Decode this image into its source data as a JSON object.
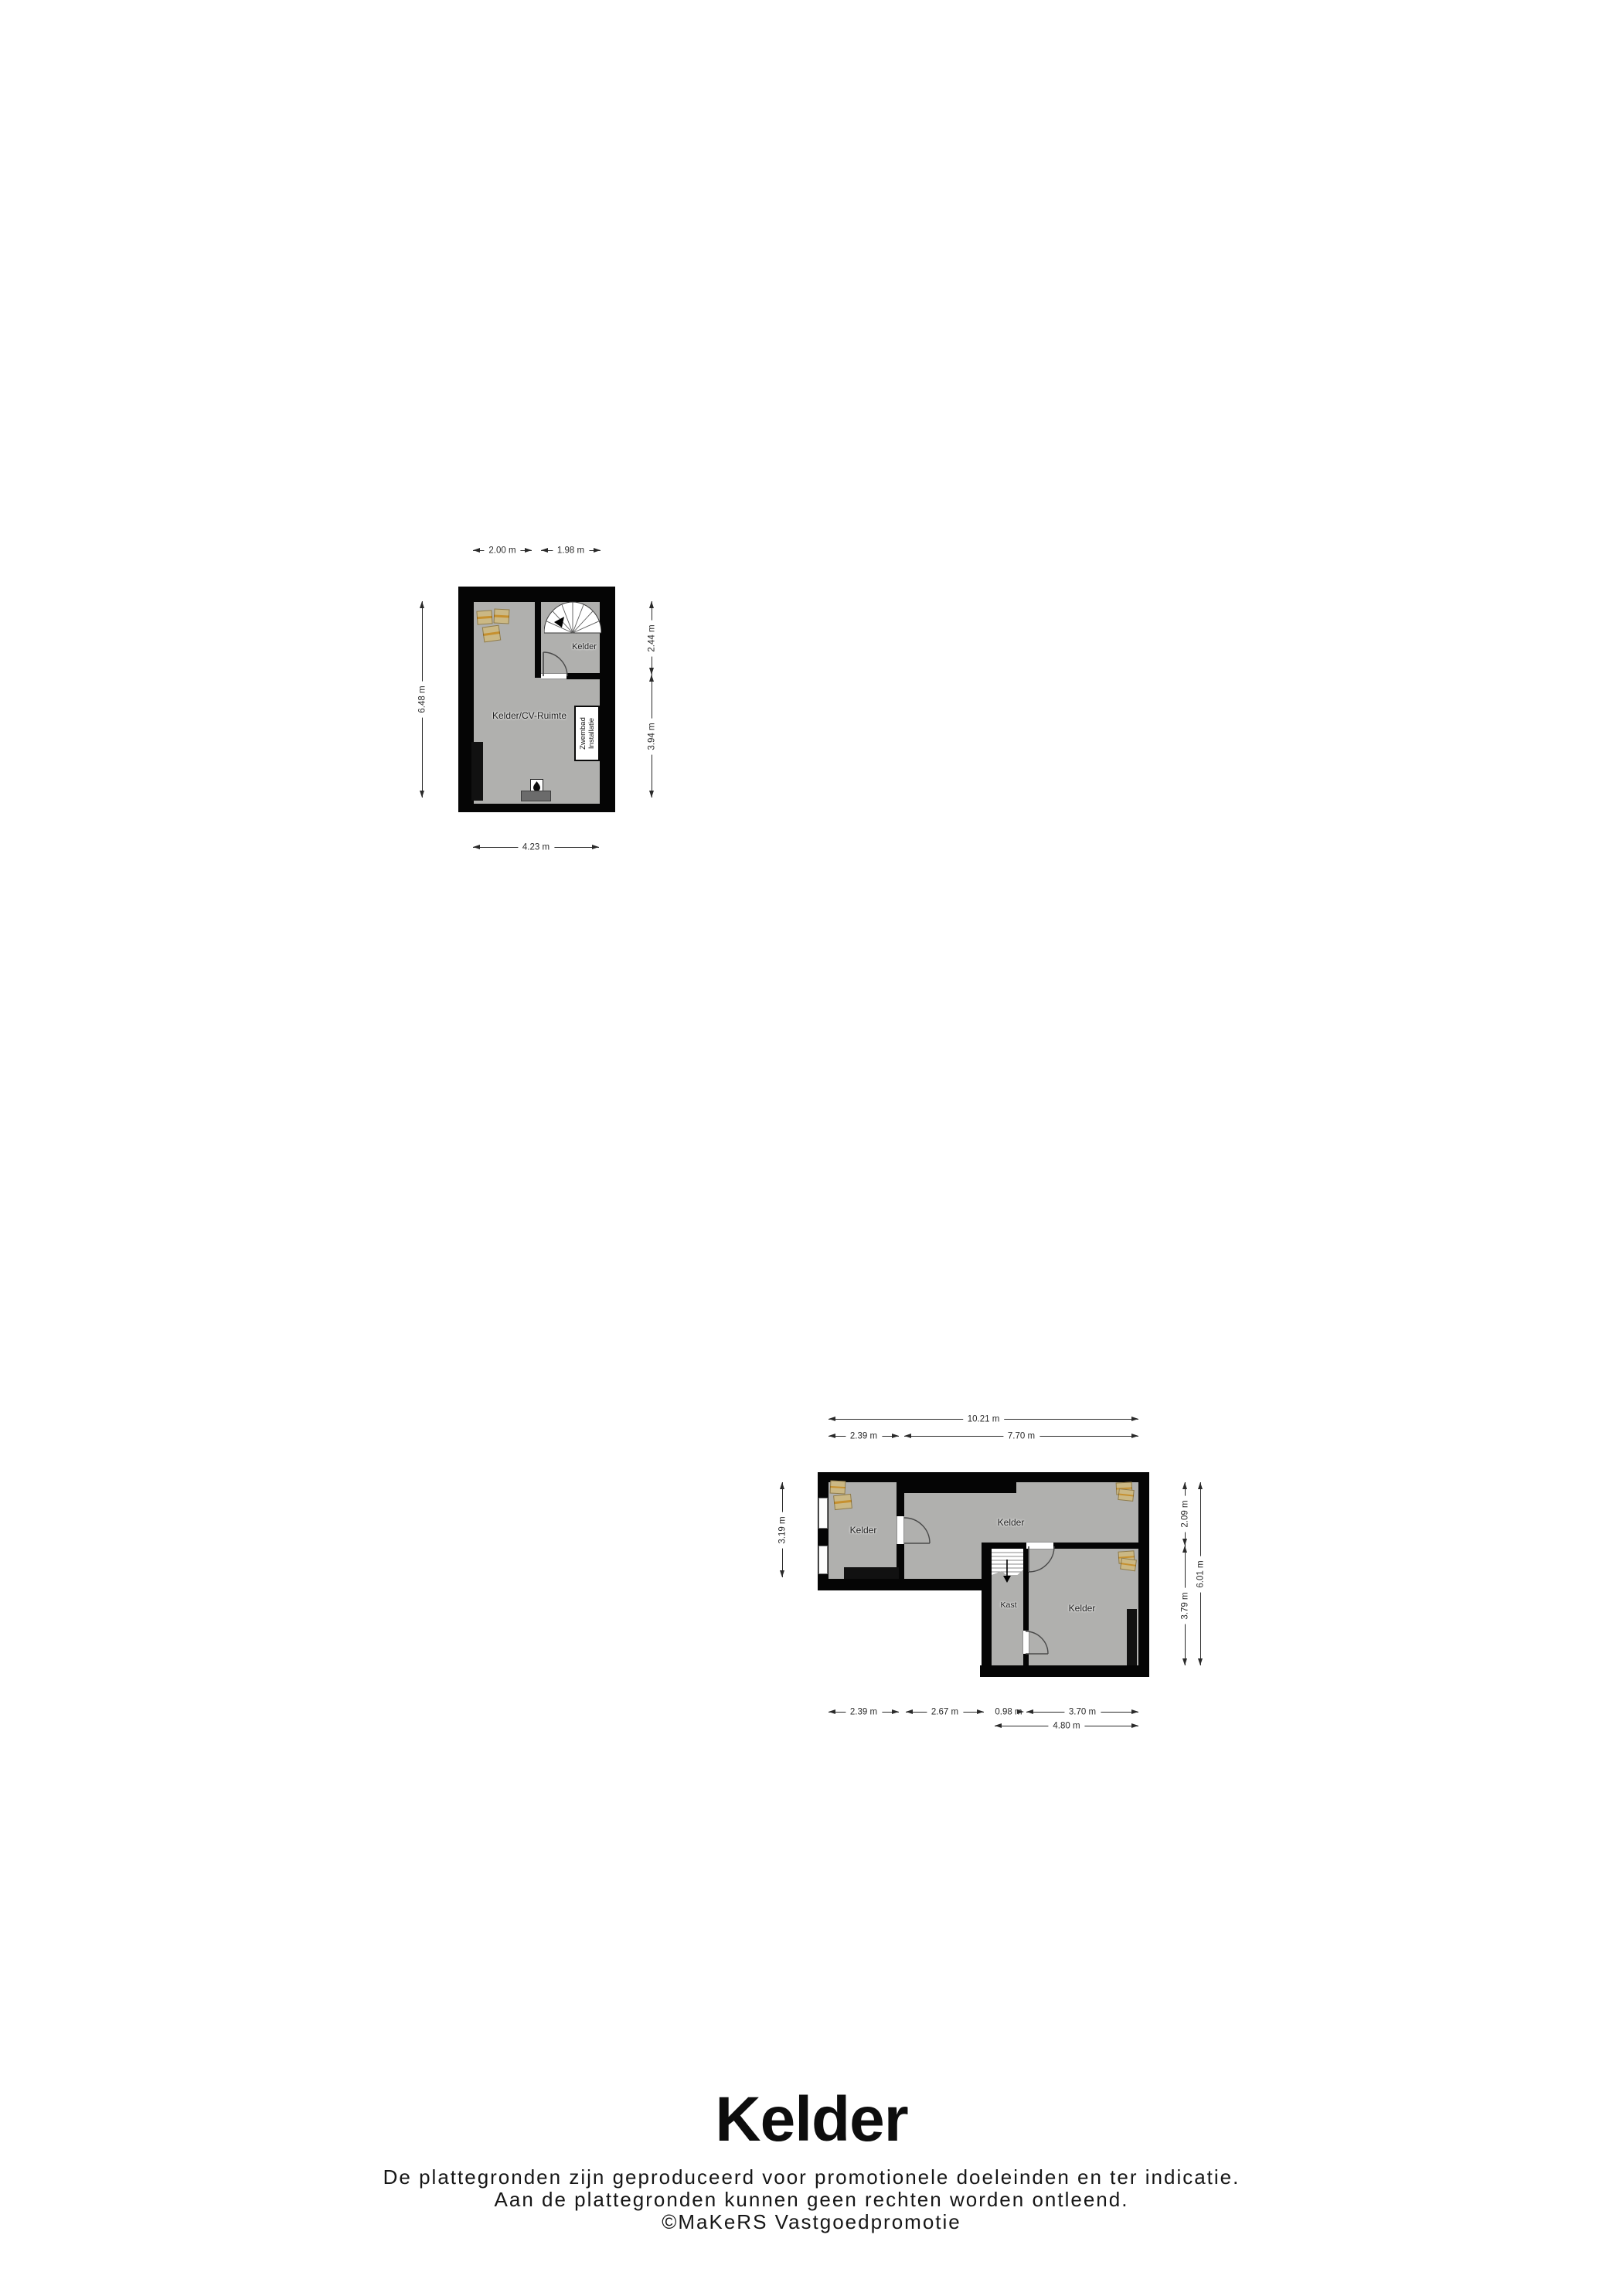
{
  "footer": {
    "title": "Kelder",
    "line1": "De plattegronden zijn geproduceerd voor promotionele doeleinden en ter indicatie.",
    "line2": "Aan de plattegronden kunnen geen rechten worden ontleend.",
    "line3": "©MaKeRS Vastgoedpromotie"
  },
  "plan1": {
    "rooms": {
      "stair_room": "Kelder",
      "main_room": "Kelder/CV-Ruimte"
    },
    "zwembad": {
      "line1": "Zwembad",
      "line2": "Installatie"
    },
    "dims": {
      "top1": "2.00 m",
      "top2": "1.98 m",
      "right1": "2.44 m",
      "right2": "3.94 m",
      "left": "6.48 m",
      "bottom": "4.23 m"
    }
  },
  "plan2": {
    "rooms": {
      "left": "Kelder",
      "middle": "Kelder",
      "kast": "Kast",
      "right": "Kelder"
    },
    "dims": {
      "top_total": "10.21 m",
      "top_left": "2.39 m",
      "top_right": "7.70 m",
      "left": "3.19 m",
      "right_top": "2.09 m",
      "right_bottom": "3.79 m",
      "right_total": "6.01 m",
      "bottom1": "2.39 m",
      "bottom2": "2.67 m",
      "bottom3": "0.98 m",
      "bottom4": "3.70 m",
      "bottom_total": "4.80 m"
    }
  },
  "colors": {
    "wall": "#050505",
    "floor": "#b0b0ae",
    "step": "#6b6b6b",
    "box_body": "#cbb884",
    "box_stripe": "#c6902f",
    "dim": "#2a2a2a",
    "label": "#1c1c1c"
  }
}
